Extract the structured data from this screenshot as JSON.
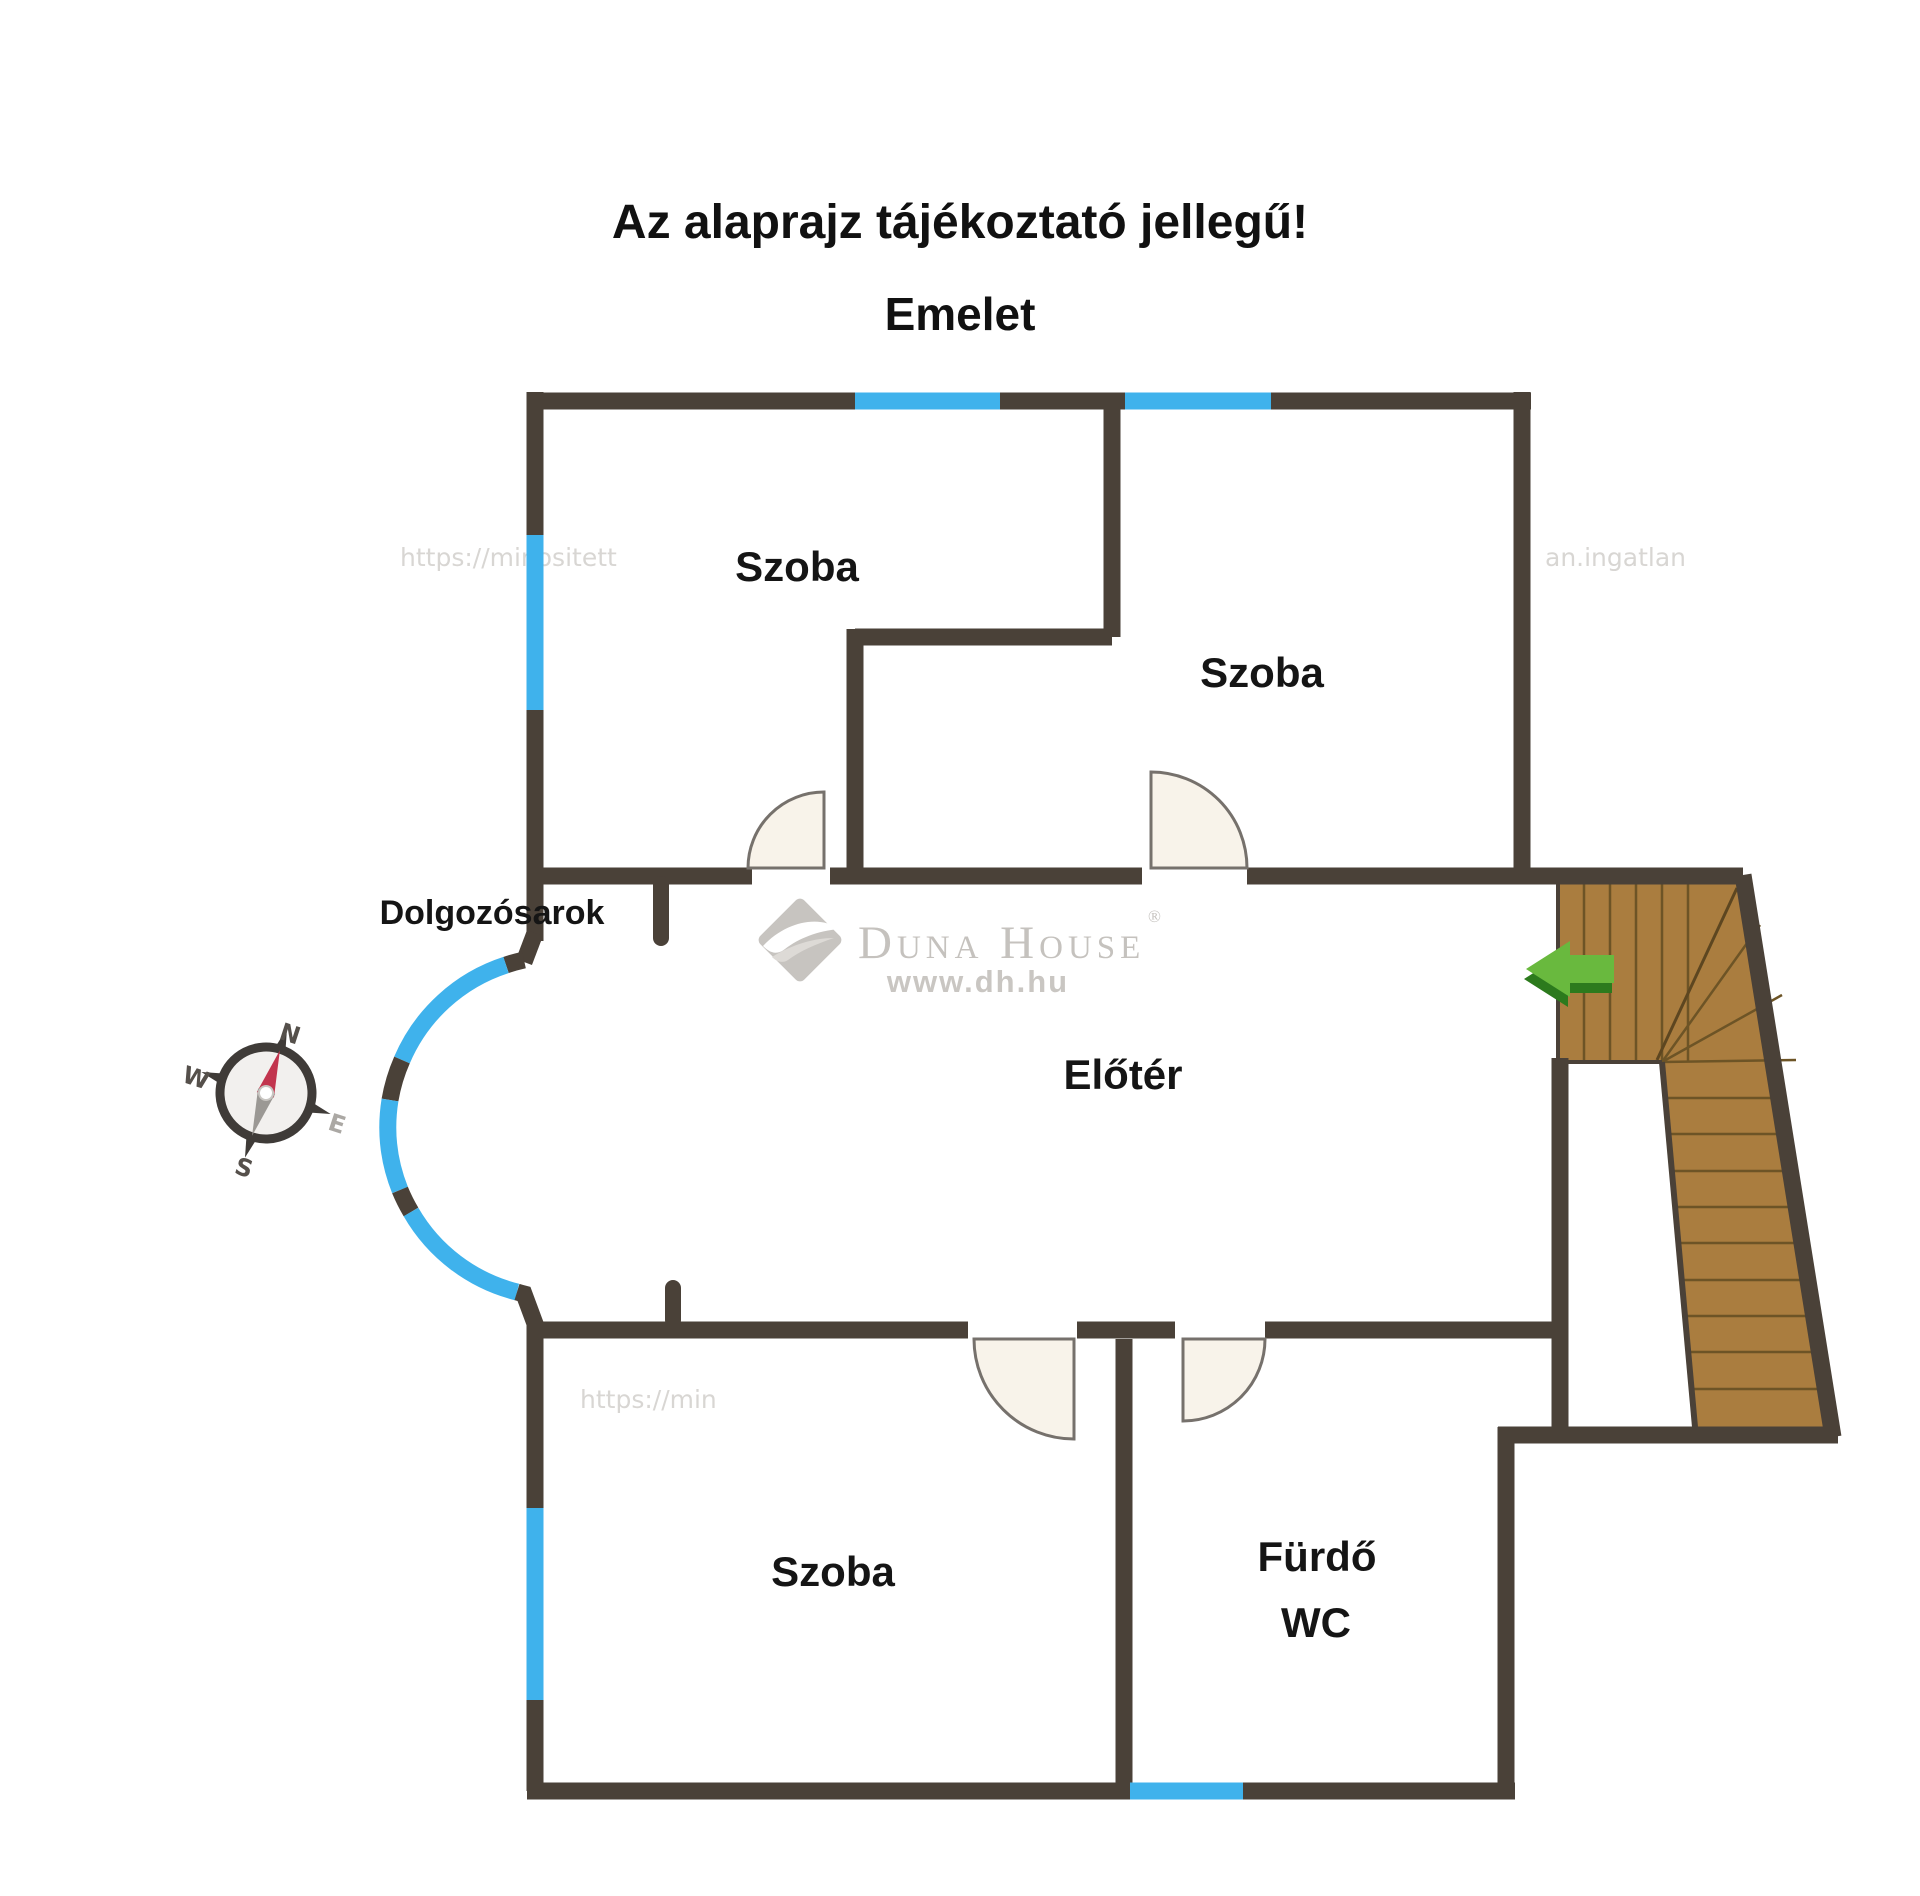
{
  "title": {
    "line1": "Az alaprajz tájékoztató jellegű!",
    "line2": "Emelet"
  },
  "rooms": {
    "room_top_left": "Szoba",
    "room_top_right": "Szoba",
    "room_bottom_left": "Szoba",
    "work_corner": "Dolgozósarok",
    "hall": "Előtér",
    "bathroom_line1": "Fürdő",
    "bathroom_line2": "WC"
  },
  "logo": {
    "brand": "Duna House",
    "registered": "®",
    "url": "www.dh.hu"
  },
  "compass": {
    "n": "N",
    "w": "W",
    "e": "E",
    "s": "S"
  },
  "watermarks": [
    "https://minositett",
    "an.ingatlan",
    "https://minositettin",
    "https://minos",
    "https://",
    "https://min"
  ],
  "colors": {
    "wall": "#4a4138",
    "window_blue": "#3fb2ec",
    "stair_wood": "#aa7d3f",
    "stair_line": "#6d5426",
    "door_fill": "#f8f3ea",
    "door_stroke": "#76716c",
    "arrow_green_light": "#69b93e",
    "arrow_green_dark": "#2c7a1d",
    "logo_gray": "#c5c2be",
    "compass_needle_red": "#c2354e",
    "label_black": "#151515",
    "background": "#ffffff"
  }
}
